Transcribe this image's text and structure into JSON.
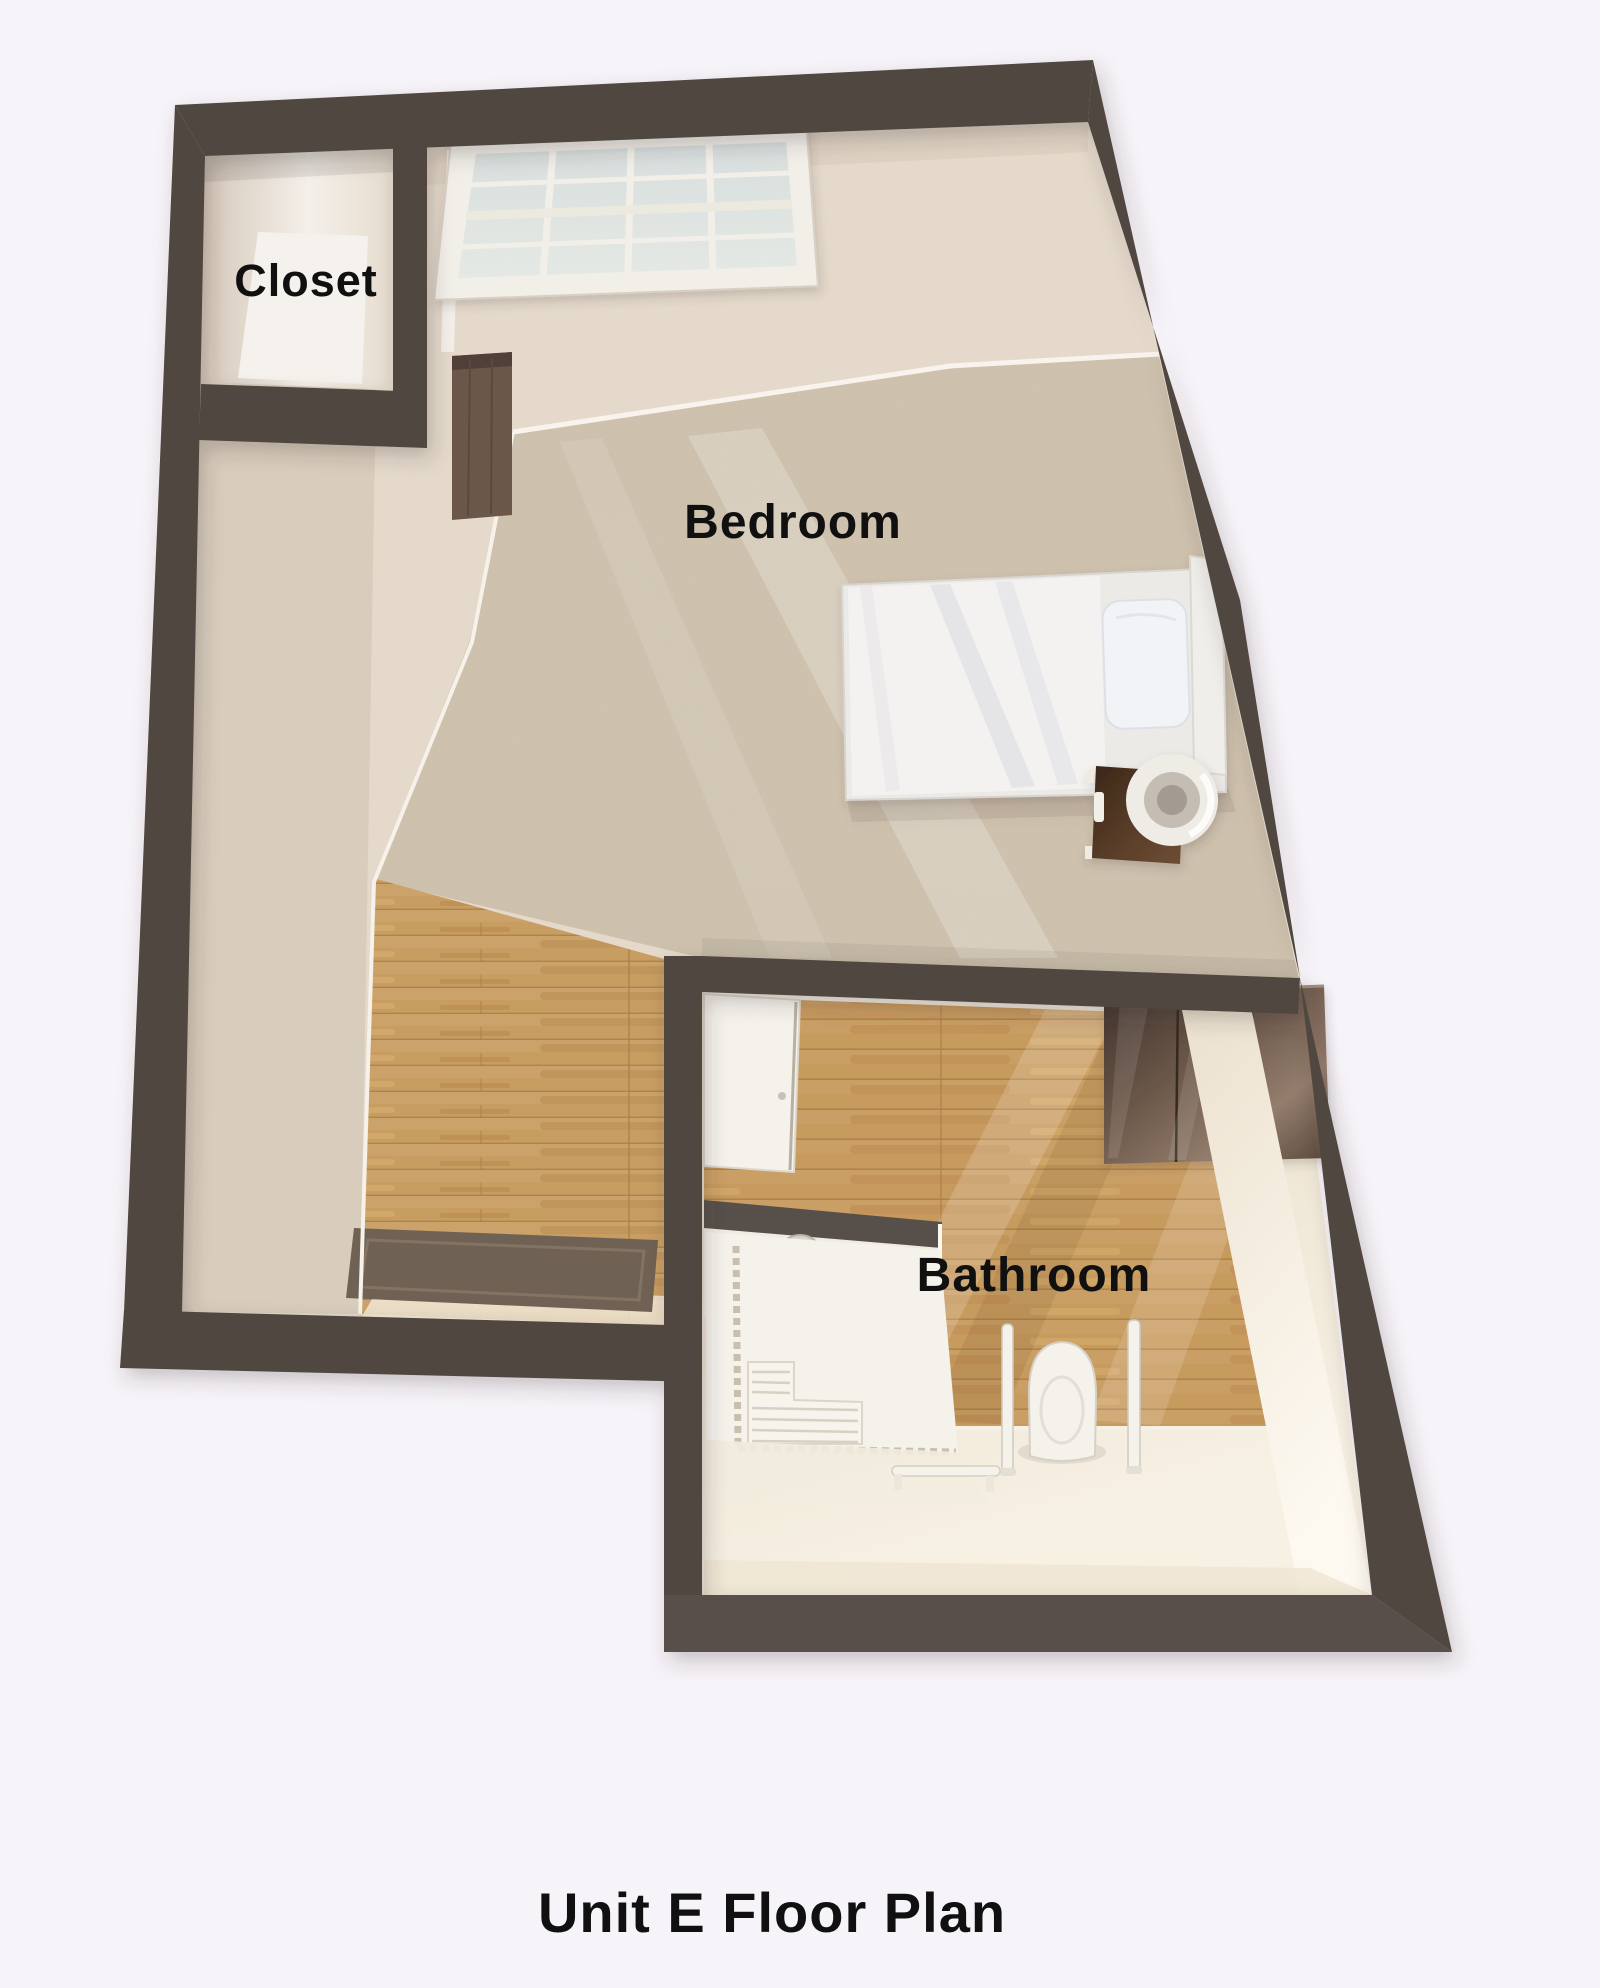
{
  "title": "Unit E Floor Plan",
  "rooms": {
    "closet": {
      "label": "Closet"
    },
    "bedroom": {
      "label": "Bedroom"
    },
    "bathroom": {
      "label": "Bathroom"
    }
  },
  "colors": {
    "background": "#f7f4f9",
    "wall": "#4f4640",
    "wall_face": "#e4d9cb",
    "carpet": "#c7b9a3",
    "wood_floor": "#c89d61",
    "wood_seam": "#a87e49",
    "bathroom_floor": "#ece2d0",
    "glass": "#dce3e1",
    "fixture_white": "#f5f2ec",
    "vanity_dark": "#53443c",
    "nightstand_dark": "#4e3626",
    "rug": "#6f6154",
    "label_text": "#101010"
  },
  "fixtures": [
    "skylight-window",
    "wardrobe",
    "bed",
    "duvet",
    "pillow",
    "headboard",
    "nightstand",
    "lamp",
    "area-rug",
    "bathroom-door",
    "shower-partition",
    "shower-head",
    "shower-bench",
    "shower-tile-border",
    "toilet",
    "grab-bar",
    "vanity-cabinet",
    "towel-bar"
  ]
}
